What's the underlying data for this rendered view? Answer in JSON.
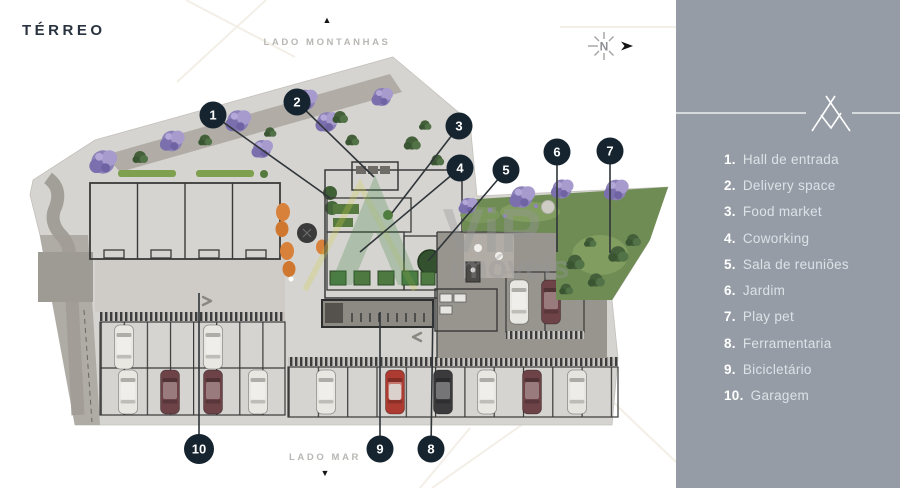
{
  "title": "TÉRREO",
  "orientation": {
    "top_label": "LADO MONTANHAS",
    "top_arrow": "▲",
    "bottom_label": "LADO MAR",
    "bottom_arrow": "▼",
    "compass_letter": "N"
  },
  "watermark": {
    "brand": "ViP",
    "brand_sub": "imóveis"
  },
  "legend": {
    "items": [
      {
        "num": "1.",
        "label": "Hall de entrada"
      },
      {
        "num": "2.",
        "label": "Delivery space"
      },
      {
        "num": "3.",
        "label": "Food market"
      },
      {
        "num": "4.",
        "label": "Coworking"
      },
      {
        "num": "5.",
        "label": "Sala de reuniões"
      },
      {
        "num": "6.",
        "label": "Jardim"
      },
      {
        "num": "7.",
        "label": "Play pet"
      },
      {
        "num": "8.",
        "label": "Ferramentaria"
      },
      {
        "num": "9.",
        "label": "Bicicletário"
      },
      {
        "num": "10.",
        "label": "Garagem"
      }
    ]
  },
  "callouts": [
    {
      "num": "1",
      "x": 213,
      "y": 115,
      "tx": 330,
      "ty": 198
    },
    {
      "num": "2",
      "x": 297,
      "y": 102,
      "tx": 374,
      "ty": 177
    },
    {
      "num": "3",
      "x": 459,
      "y": 126,
      "tx": 392,
      "ty": 213
    },
    {
      "num": "4",
      "x": 460,
      "y": 168,
      "tx": 360,
      "ty": 252
    },
    {
      "num": "5",
      "x": 506,
      "y": 170,
      "tx": 428,
      "ty": 261
    },
    {
      "num": "6",
      "x": 557,
      "y": 152,
      "tx": 557,
      "ty": 252
    },
    {
      "num": "7",
      "x": 610,
      "y": 151,
      "tx": 610,
      "ty": 253
    },
    {
      "num": "8",
      "x": 431,
      "y": 449,
      "tx": 433,
      "ty": 306
    },
    {
      "num": "9",
      "x": 380,
      "y": 449,
      "tx": 380,
      "ty": 312
    },
    {
      "num": "10",
      "x": 199,
      "y": 449,
      "tx": 199,
      "ty": 293
    }
  ],
  "colors": {
    "panel": "#959ca5",
    "marker": "#15242f",
    "title": "#28333f",
    "pavement": "#d6d4d0",
    "garden": "#6f8c55",
    "tree_purple": "#8d82b8",
    "chair_orange": "#d8813a"
  }
}
